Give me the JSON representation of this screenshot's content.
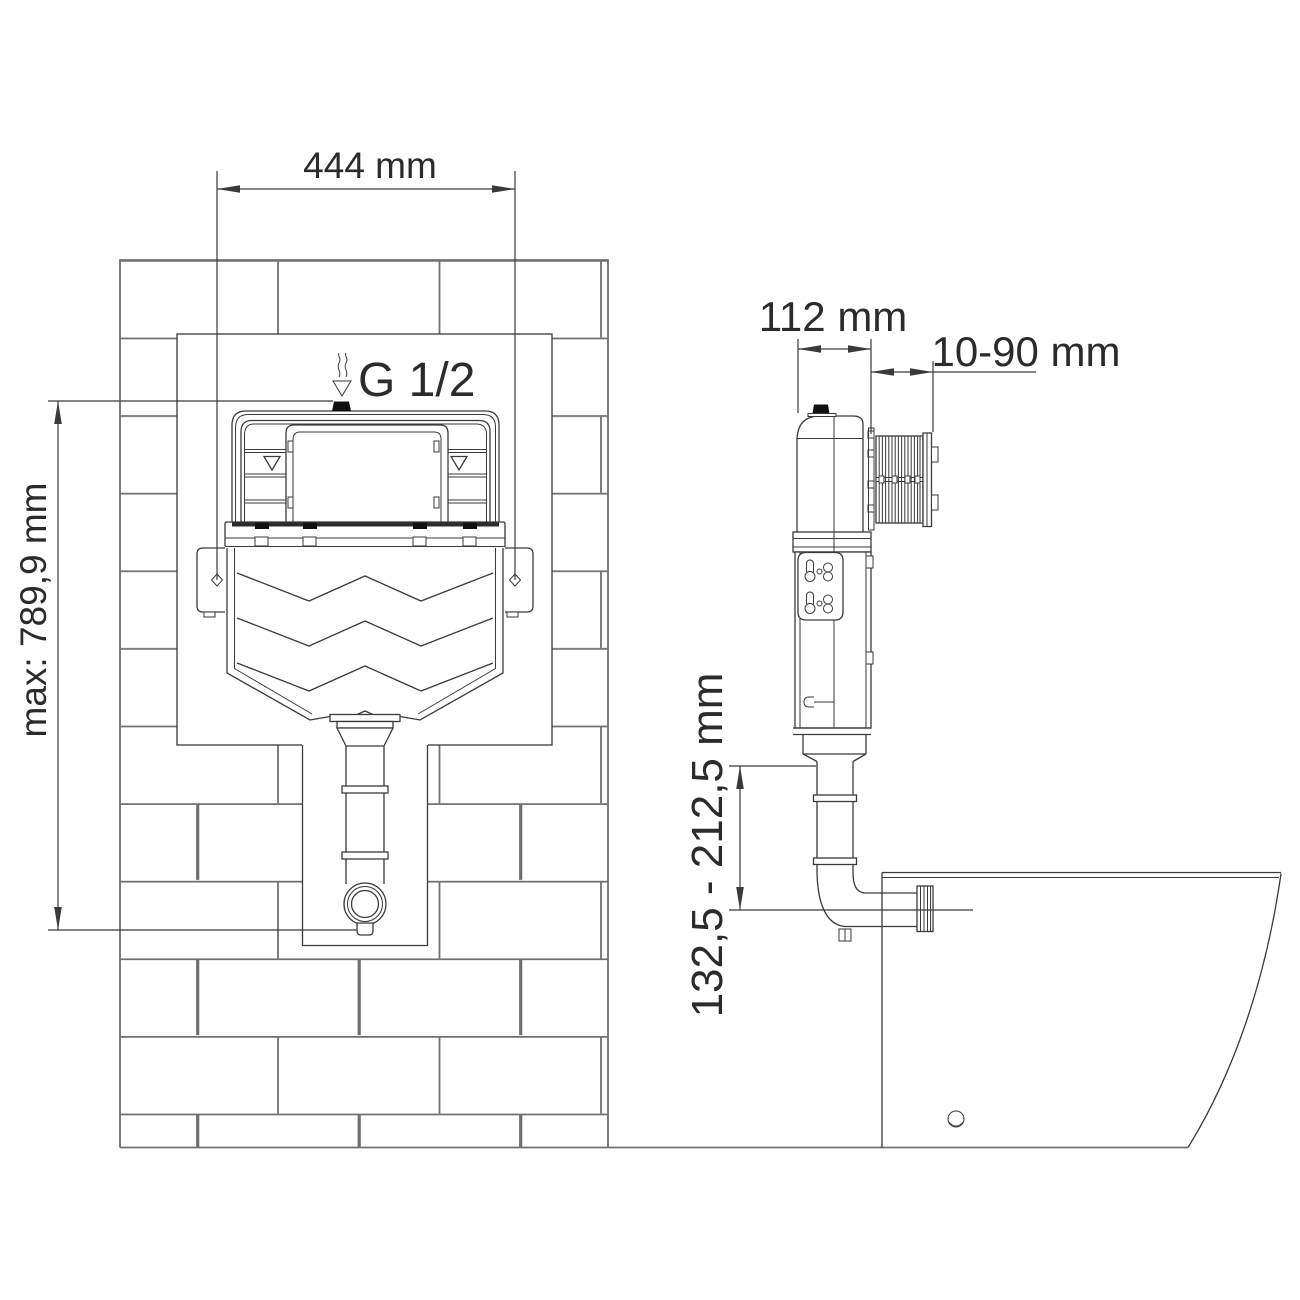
{
  "labels": {
    "front_width": "444 mm",
    "front_height": "max: 789,9 mm",
    "inlet": "G 1/2",
    "side_depth": "112 mm",
    "side_wall_range": "10-90 mm",
    "side_outlet_range": "132,5 - 212,5 mm"
  },
  "colors": {
    "part_line": "#3a3a3a",
    "wall_line": "#707070",
    "text": "#2b2b2b",
    "solid_fill": "#111111",
    "background": "#ffffff"
  }
}
